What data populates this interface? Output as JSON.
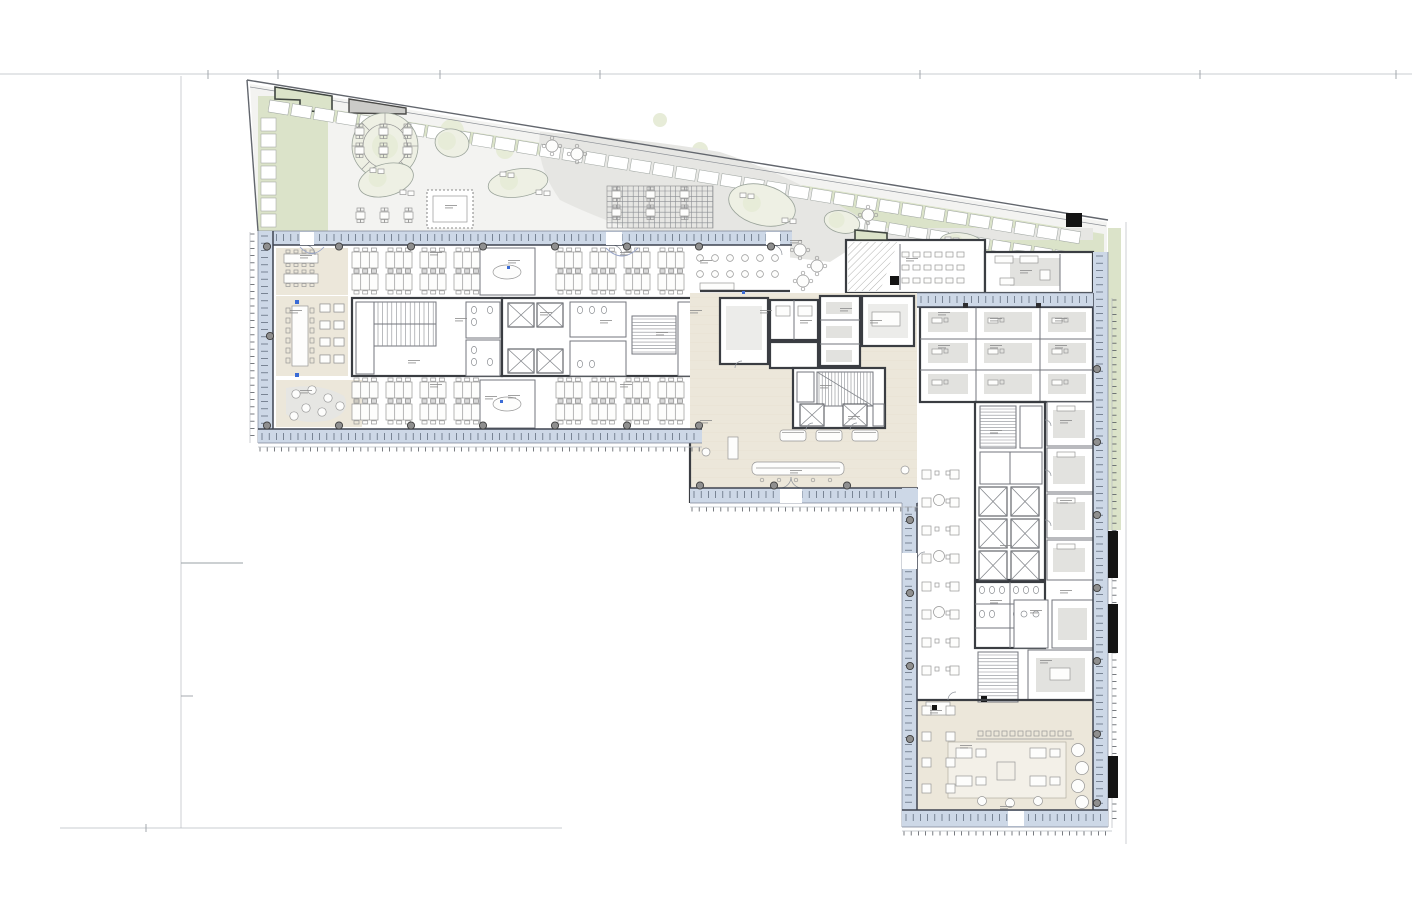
{
  "document": {
    "background": "#ffffff"
  },
  "palette": {
    "paper": "#ffffff",
    "faint_line": "#b7bbc1",
    "boundary": "#62666d",
    "green": "#dbe3c9",
    "green_soft": "#e7ecd8",
    "terrace_gray": "#f3f3f1",
    "beige": "#ece7da",
    "beige_soft": "#f3f0e8",
    "facade": "#cdd8e7",
    "facade_line": "#3e4450",
    "mullion": "#556070",
    "wall": "#3a3d42",
    "partition": "#73767c",
    "furniture_stroke": "#979797",
    "furniture_fill": "#fdfdfc",
    "rug": "#e2e2df",
    "column": "#8f8f8f",
    "column_ring": "#3d3d3d",
    "black": "#141414",
    "accent_blue": "#3a6bd6",
    "label": "#8a8a8a"
  },
  "zones": [
    {
      "name": "roof-terrace",
      "color": "#f3f3f1"
    },
    {
      "name": "terrace-planting",
      "color": "#dbe3c9"
    },
    {
      "name": "left-wing-open-office",
      "color": "#ffffff"
    },
    {
      "name": "cafeteria-lounge",
      "color": "#ece7da"
    },
    {
      "name": "lobby",
      "color": "#ede9de"
    },
    {
      "name": "right-wing-rooms",
      "color": "#ffffff"
    },
    {
      "name": "restaurant",
      "color": "#ece7da"
    },
    {
      "name": "facade-band",
      "color": "#cdd8e7"
    }
  ],
  "markers": {
    "accent_blue_dots": 4,
    "black_facade_panels": 3,
    "black_roof_skylight": 1
  }
}
